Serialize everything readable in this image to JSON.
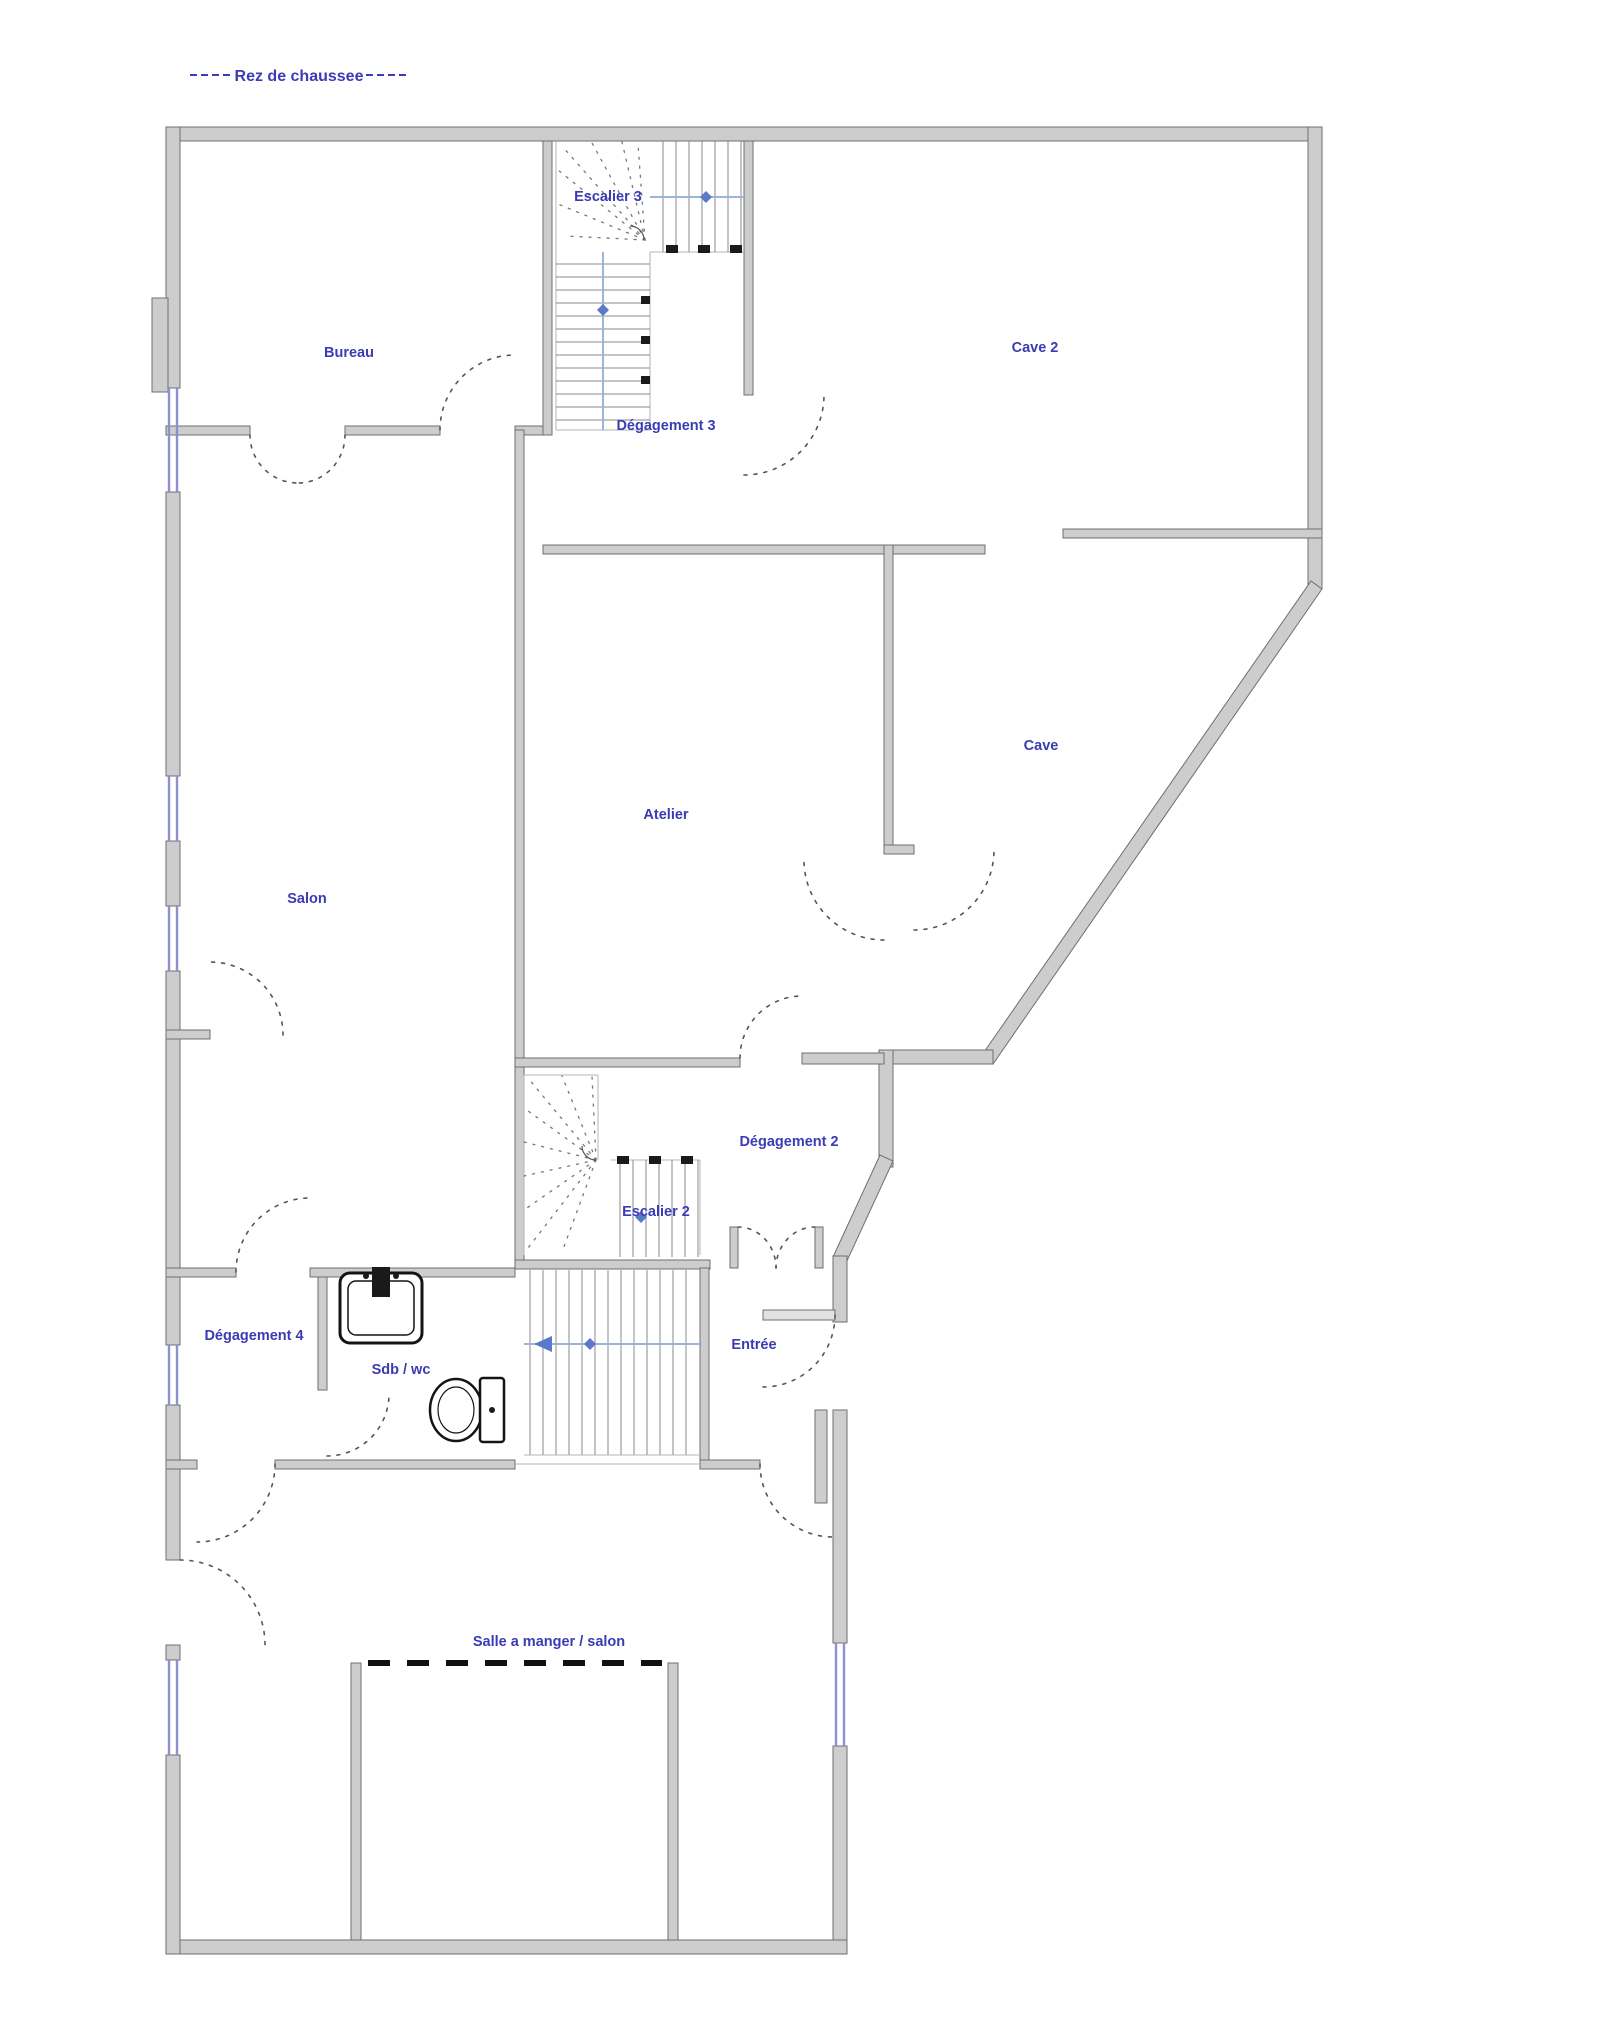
{
  "title": {
    "text": "Rez de chaussee"
  },
  "rooms": [
    {
      "id": "bureau",
      "label": "Bureau"
    },
    {
      "id": "escalier-3",
      "label": "Escalier 3"
    },
    {
      "id": "cave-2",
      "label": "Cave 2"
    },
    {
      "id": "degagement-3",
      "label": "Dégagement 3"
    },
    {
      "id": "atelier",
      "label": "Atelier"
    },
    {
      "id": "cave",
      "label": "Cave"
    },
    {
      "id": "salon",
      "label": "Salon"
    },
    {
      "id": "degagement-2",
      "label": "Dégagement 2"
    },
    {
      "id": "escalier-2",
      "label": "Escalier 2"
    },
    {
      "id": "degagement-4",
      "label": "Dégagement 4"
    },
    {
      "id": "sdb-wc",
      "label": "Sdb / wc"
    },
    {
      "id": "entree",
      "label": "Entrée"
    },
    {
      "id": "salle-a-manger",
      "label": "Salle a manger / salon"
    }
  ],
  "fixtures": [
    {
      "id": "sink",
      "name": "sink"
    },
    {
      "id": "toilet",
      "name": "toilet"
    }
  ],
  "colors": {
    "label": "#3b3bb5",
    "wall_fill": "#cdcdcd",
    "wall_edge": "#6f6f6f",
    "window": "#8b90cf",
    "arrow": "#5b79c9",
    "arrow_line": "#9db3d9",
    "door_arc": "#555555",
    "background": "#ffffff"
  }
}
